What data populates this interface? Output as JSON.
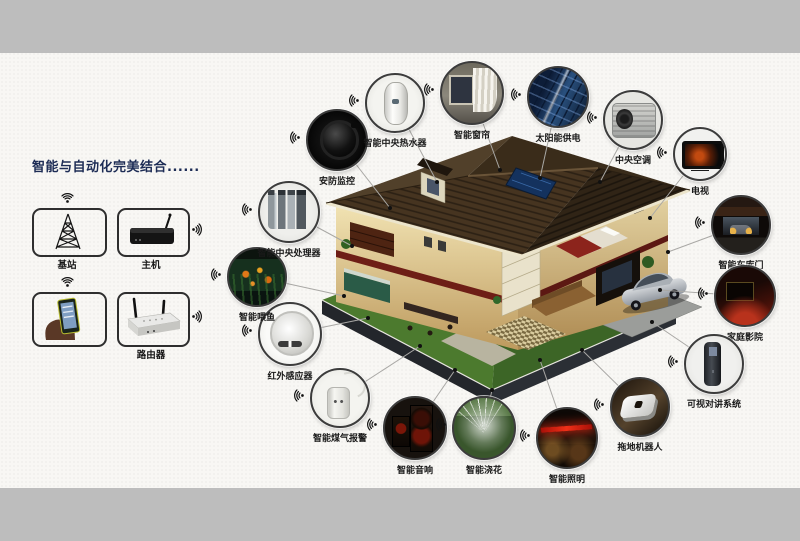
{
  "page": {
    "top_band_color": "#bdbdbd",
    "bottom_band_color": "#bdbdbd",
    "background_color": "#f8f7f4"
  },
  "intro": {
    "heading": "智能与自动化完美结合......"
  },
  "hub": {
    "items": [
      {
        "id": "base-station",
        "label": "基站",
        "icon": "signal-tower-icon"
      },
      {
        "id": "host",
        "label": "主机",
        "icon": "host-box-icon"
      },
      {
        "id": "smartphone",
        "label": "",
        "icon": "hand-holding-phone-icon"
      },
      {
        "id": "router",
        "label": "路由器",
        "icon": "wireless-router-icon"
      }
    ]
  },
  "house": {
    "icon": "smart-home-cutaway-illustration"
  },
  "nodes": [
    {
      "id": "security-camera",
      "label": "安防监控",
      "icon": "dome-camera-photo"
    },
    {
      "id": "water-heater",
      "label": "智能中央热水器",
      "icon": "water-heater-photo"
    },
    {
      "id": "curtain",
      "label": "智能窗帘",
      "icon": "curtains-photo"
    },
    {
      "id": "solar-power",
      "label": "太阳能供电",
      "icon": "solar-panels-photo"
    },
    {
      "id": "central-ac",
      "label": "中央空调",
      "icon": "ac-outdoor-unit-photo"
    },
    {
      "id": "tv",
      "label": "电视",
      "icon": "television-photo"
    },
    {
      "id": "garage-door",
      "label": "智能车库门",
      "icon": "garage-photo"
    },
    {
      "id": "home-theater",
      "label": "家庭影院",
      "icon": "home-theater-photo"
    },
    {
      "id": "video-intercom",
      "label": "可视对讲系统",
      "icon": "door-intercom-photo"
    },
    {
      "id": "mop-robot",
      "label": "拖地机器人",
      "icon": "mopping-robot-photo"
    },
    {
      "id": "lighting",
      "label": "智能照明",
      "icon": "lit-room-photo"
    },
    {
      "id": "watering",
      "label": "智能浇花",
      "icon": "lawn-sprinkler-photo"
    },
    {
      "id": "speaker",
      "label": "智能音响",
      "icon": "speakers-photo"
    },
    {
      "id": "gas-alarm",
      "label": "智能煤气报警",
      "icon": "gas-alarm-photo"
    },
    {
      "id": "ir-sensor",
      "label": "红外感应器",
      "icon": "infrared-sensor-photo"
    },
    {
      "id": "fish-feeding",
      "label": "智能喂鱼",
      "icon": "aquarium-photo"
    },
    {
      "id": "cpu",
      "label": "智能中央处理器",
      "icon": "controller-modules-photo"
    }
  ]
}
